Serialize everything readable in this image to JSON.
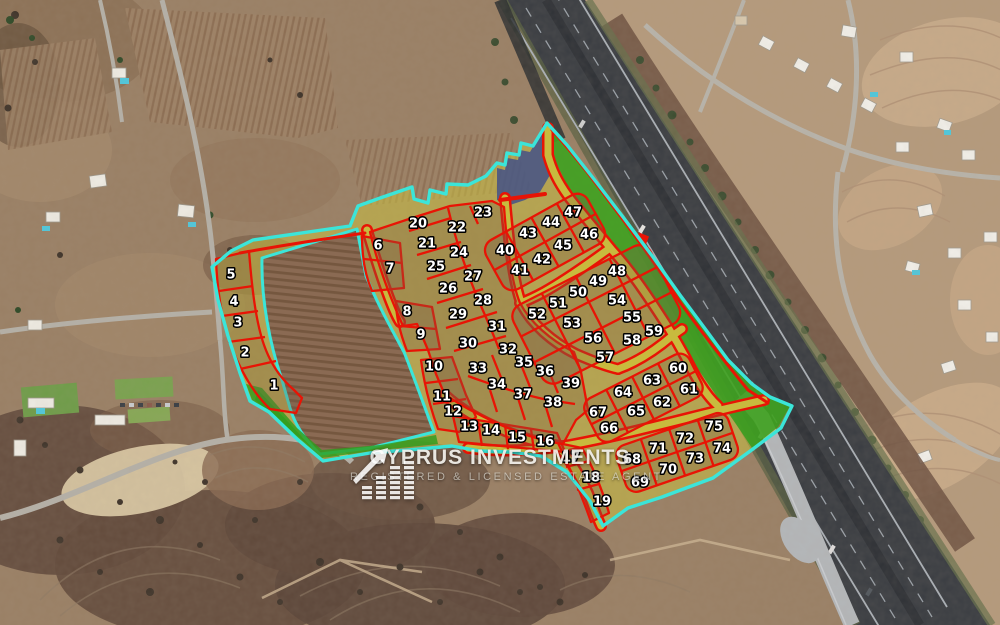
{
  "watermark": {
    "title": "CYPRUS INVESTMENTS",
    "subtitle": "REGISTERED & LICENSED ESTATE AGENT"
  },
  "map": {
    "type": "land-plot-subdivision-overlay",
    "description": "Satellite aerial view with numbered land plots outlined in red inside a cyan development boundary, beside a motorway",
    "plot_count": 75,
    "colors": {
      "boundary_cyan": "#3BE5D9",
      "plot_line_red": "#E81405",
      "road_olive": "#C8BA3E",
      "zone_olive": "#D2C83C",
      "green_area": "#2F9E1D",
      "blue_area": "#3A4A8C",
      "highway_asphalt": "#3A3D42",
      "label_fill": "#FFFFFF",
      "label_stroke": "#000000"
    },
    "plots": [
      {
        "n": 1,
        "x": 274,
        "y": 385
      },
      {
        "n": 2,
        "x": 245,
        "y": 352
      },
      {
        "n": 3,
        "x": 238,
        "y": 322
      },
      {
        "n": 4,
        "x": 234,
        "y": 301
      },
      {
        "n": 5,
        "x": 231,
        "y": 274
      },
      {
        "n": 6,
        "x": 378,
        "y": 245
      },
      {
        "n": 7,
        "x": 390,
        "y": 268
      },
      {
        "n": 8,
        "x": 407,
        "y": 311
      },
      {
        "n": 9,
        "x": 421,
        "y": 334
      },
      {
        "n": 10,
        "x": 434,
        "y": 366
      },
      {
        "n": 11,
        "x": 442,
        "y": 396
      },
      {
        "n": 12,
        "x": 453,
        "y": 411
      },
      {
        "n": 13,
        "x": 469,
        "y": 426
      },
      {
        "n": 14,
        "x": 491,
        "y": 430
      },
      {
        "n": 15,
        "x": 517,
        "y": 437
      },
      {
        "n": 16,
        "x": 545,
        "y": 441
      },
      {
        "n": 17,
        "x": 571,
        "y": 457
      },
      {
        "n": 18,
        "x": 591,
        "y": 477
      },
      {
        "n": 19,
        "x": 602,
        "y": 501
      },
      {
        "n": 20,
        "x": 418,
        "y": 223
      },
      {
        "n": 21,
        "x": 427,
        "y": 243
      },
      {
        "n": 22,
        "x": 457,
        "y": 227
      },
      {
        "n": 23,
        "x": 483,
        "y": 212
      },
      {
        "n": 24,
        "x": 459,
        "y": 252
      },
      {
        "n": 25,
        "x": 436,
        "y": 266
      },
      {
        "n": 26,
        "x": 448,
        "y": 288
      },
      {
        "n": 27,
        "x": 473,
        "y": 276
      },
      {
        "n": 28,
        "x": 483,
        "y": 300
      },
      {
        "n": 29,
        "x": 458,
        "y": 314
      },
      {
        "n": 30,
        "x": 468,
        "y": 343
      },
      {
        "n": 31,
        "x": 497,
        "y": 326
      },
      {
        "n": 32,
        "x": 508,
        "y": 349
      },
      {
        "n": 33,
        "x": 478,
        "y": 368
      },
      {
        "n": 34,
        "x": 497,
        "y": 384
      },
      {
        "n": 35,
        "x": 524,
        "y": 362
      },
      {
        "n": 36,
        "x": 545,
        "y": 371
      },
      {
        "n": 37,
        "x": 523,
        "y": 394
      },
      {
        "n": 38,
        "x": 553,
        "y": 402
      },
      {
        "n": 39,
        "x": 571,
        "y": 383
      },
      {
        "n": 40,
        "x": 505,
        "y": 250
      },
      {
        "n": 41,
        "x": 520,
        "y": 270
      },
      {
        "n": 42,
        "x": 542,
        "y": 259
      },
      {
        "n": 43,
        "x": 528,
        "y": 233
      },
      {
        "n": 44,
        "x": 551,
        "y": 222
      },
      {
        "n": 45,
        "x": 563,
        "y": 245
      },
      {
        "n": 46,
        "x": 589,
        "y": 234
      },
      {
        "n": 47,
        "x": 573,
        "y": 212
      },
      {
        "n": 48,
        "x": 617,
        "y": 271
      },
      {
        "n": 49,
        "x": 598,
        "y": 281
      },
      {
        "n": 50,
        "x": 578,
        "y": 292
      },
      {
        "n": 51,
        "x": 558,
        "y": 303
      },
      {
        "n": 52,
        "x": 537,
        "y": 314
      },
      {
        "n": 53,
        "x": 572,
        "y": 323
      },
      {
        "n": 54,
        "x": 617,
        "y": 300
      },
      {
        "n": 55,
        "x": 632,
        "y": 317
      },
      {
        "n": 56,
        "x": 593,
        "y": 338
      },
      {
        "n": 57,
        "x": 605,
        "y": 357
      },
      {
        "n": 58,
        "x": 632,
        "y": 340
      },
      {
        "n": 59,
        "x": 654,
        "y": 331
      },
      {
        "n": 60,
        "x": 678,
        "y": 368
      },
      {
        "n": 61,
        "x": 689,
        "y": 389
      },
      {
        "n": 62,
        "x": 662,
        "y": 402
      },
      {
        "n": 63,
        "x": 652,
        "y": 380
      },
      {
        "n": 64,
        "x": 623,
        "y": 392
      },
      {
        "n": 65,
        "x": 636,
        "y": 411
      },
      {
        "n": 66,
        "x": 609,
        "y": 428
      },
      {
        "n": 67,
        "x": 598,
        "y": 412
      },
      {
        "n": 68,
        "x": 632,
        "y": 459
      },
      {
        "n": 69,
        "x": 640,
        "y": 482
      },
      {
        "n": 70,
        "x": 668,
        "y": 469
      },
      {
        "n": 71,
        "x": 658,
        "y": 448
      },
      {
        "n": 72,
        "x": 685,
        "y": 438
      },
      {
        "n": 73,
        "x": 695,
        "y": 458
      },
      {
        "n": 74,
        "x": 722,
        "y": 448
      },
      {
        "n": 75,
        "x": 714,
        "y": 426
      }
    ]
  }
}
